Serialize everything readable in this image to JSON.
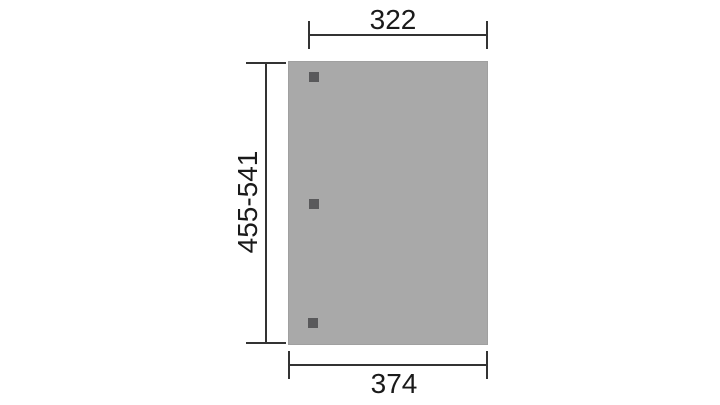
{
  "diagram": {
    "type": "dimensioned-plan-drawing",
    "subject": "rectangular roof panel plan with three post markers",
    "dimensions": {
      "top": {
        "label": "322"
      },
      "left": {
        "label": "455-541"
      },
      "bottom": {
        "label": "374"
      }
    },
    "panel": {
      "post_count": 3
    },
    "colors": {
      "background": "#ffffff",
      "panel-fill": "#a9a9a9",
      "panel-edge": "#a0a0a0",
      "post-fill": "#59595b",
      "line": "#333333",
      "text": "#1a1a1a"
    }
  }
}
